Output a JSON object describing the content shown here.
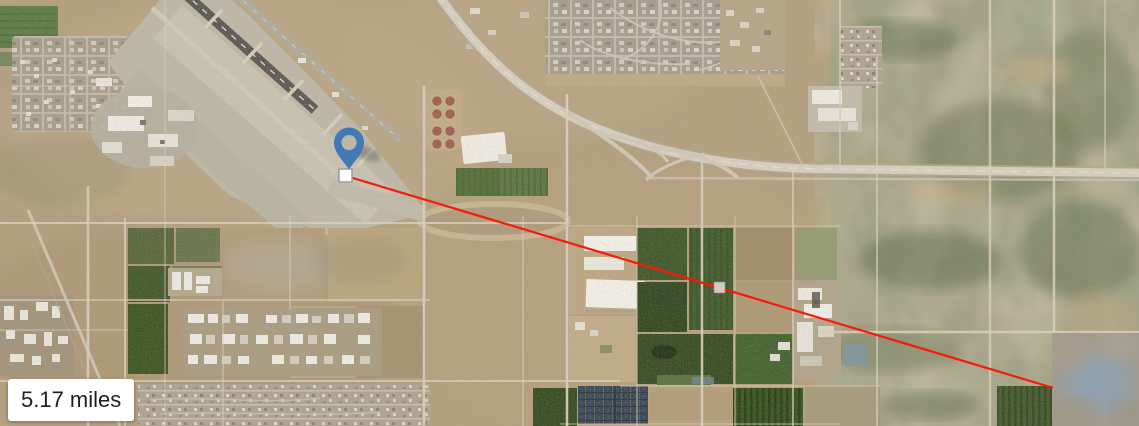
{
  "map": {
    "type": "satellite-imagery",
    "description": "Aerial satellite view: airport with diagonal runways upper-left, suburban neighborhoods and a curving highway along the top, irrigated farm fields and warehouses in the center, desert scrub on the right, solar arrays at the bottom, low-resolution blurred tile in bottom-right corner"
  },
  "measurement": {
    "label": "5.17 miles",
    "distance_value": "5.17",
    "distance_unit": "miles",
    "line_color": "#f8190a",
    "start_point": {
      "x": 346,
      "y": 176
    },
    "end_point": {
      "x": 1052,
      "y": 387.5
    },
    "start_marker": {
      "x": 339,
      "y": 169,
      "size": 13
    },
    "midpoint_handle": {
      "x": 714,
      "y": 282,
      "size": 11
    }
  },
  "pin": {
    "color": "#4379b4",
    "anchor_x": 349,
    "anchor_y": 169
  }
}
